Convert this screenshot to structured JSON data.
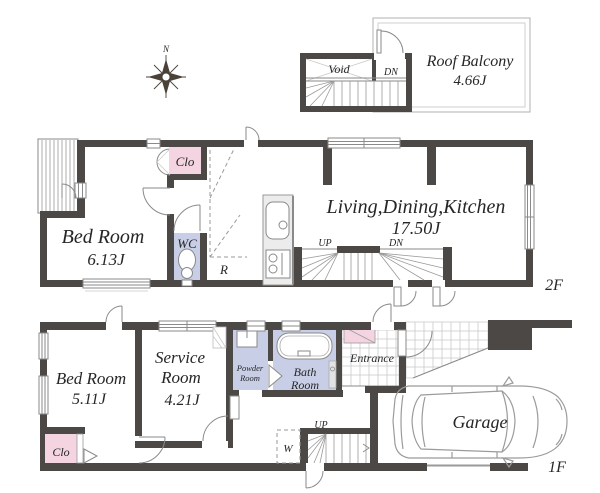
{
  "colors": {
    "wall": "#4b4846",
    "closet-pink": "#f5d4e2",
    "wet-lavender": "#c8cee6",
    "counter-gray": "#ececec",
    "line": "#8a8a8a",
    "tile-line": "#c9c9c9",
    "text": "#262626",
    "car-line": "#9b9b9b"
  },
  "compass": {
    "north": "N"
  },
  "roof": {
    "void_label": "Void",
    "down_label": "DN",
    "balcony_name": "Roof Balcony",
    "balcony_area": "4.66J"
  },
  "floor2": {
    "floor_label": "2F",
    "closet_label": "Clo",
    "bedroom_name": "Bed Room",
    "bedroom_area": "6.13J",
    "wc_label": "WC",
    "fridge_label": "R",
    "ldk_name": "Living,Dining,Kitchen",
    "ldk_area": "17.50J",
    "stairs_up": "UP",
    "stairs_down": "DN"
  },
  "floor1": {
    "floor_label": "1F",
    "bedroom_name": "Bed Room",
    "bedroom_area": "5.11J",
    "service_name_line1": "Service",
    "service_name_line2": "Room",
    "service_area": "4.21J",
    "powder_line1": "Powder",
    "powder_line2": "Room",
    "bath_line1": "Bath",
    "bath_line2": "Room",
    "entrance_label": "Entrance",
    "closet_label": "Clo",
    "washer_label": "W",
    "stairs_up": "UP",
    "garage_label": "Garage"
  }
}
